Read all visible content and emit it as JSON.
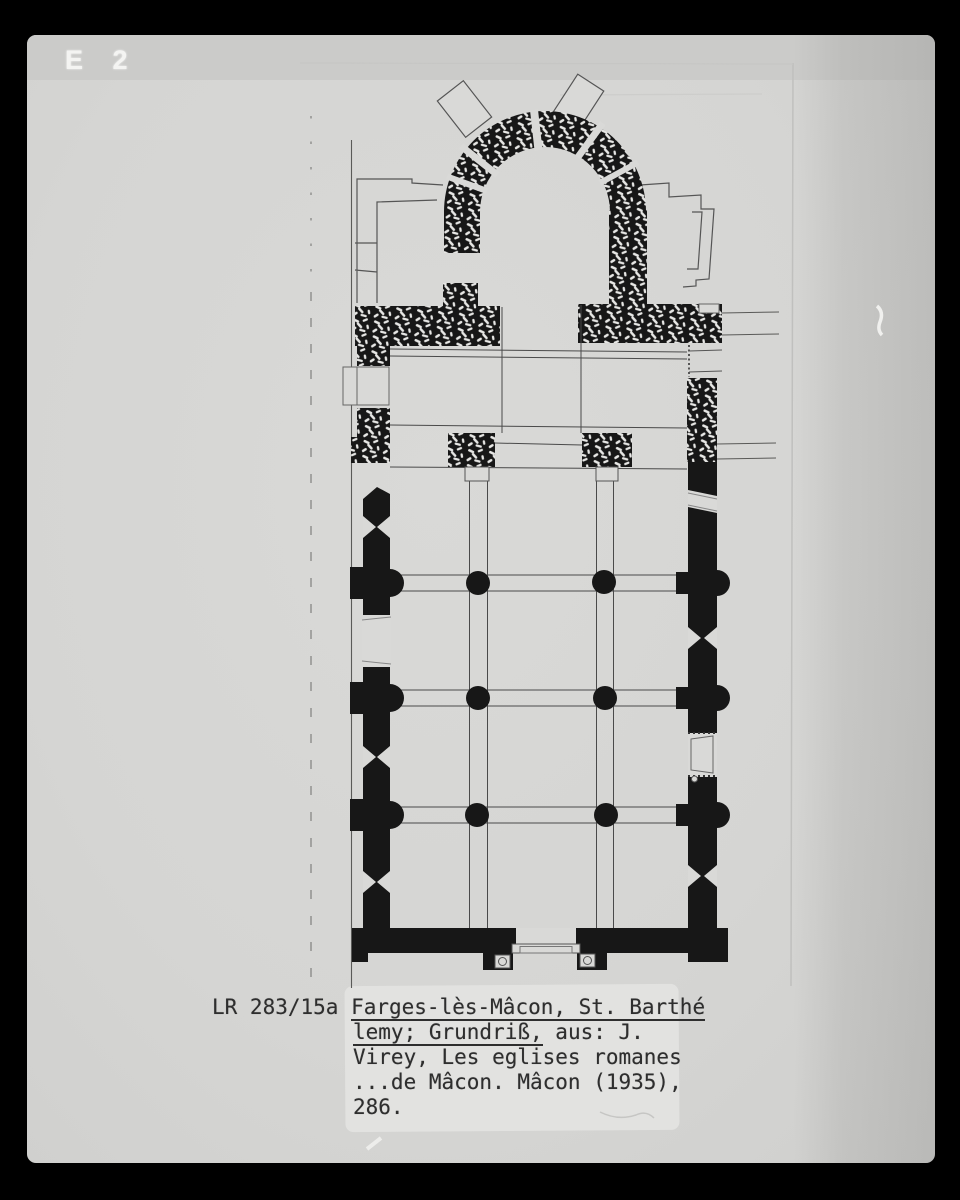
{
  "photo_label": {
    "text": "E 2"
  },
  "caption": {
    "line1_plain": "LR 283/15a ",
    "line1_underlined": "Farges-lès-Mâcon, St. Barthé",
    "line2_underlined": "lemy; Grundriß,",
    "line2_plain": " aus: J.",
    "line3": "Virey, Les eglises romanes",
    "line4": "...de Mâcon. Mâcon (1935),",
    "line5": "286."
  },
  "plan": {
    "type": "church-ground-plan",
    "nave_columns": [
      [
        478,
        583
      ],
      [
        604,
        582
      ],
      [
        478,
        698
      ],
      [
        605,
        698
      ],
      [
        477,
        815
      ],
      [
        606,
        815
      ]
    ],
    "column_radius": 12
  },
  "colors": {
    "border_black": "#000000",
    "photo_gray": "#d6d6d4",
    "top_strip_gray": "#cbcbc9",
    "caption_label": "#e2e2e0",
    "drawing_ink": "#171717",
    "thin_line": "#4a4a4a",
    "caption_ink": "#2e2e2e",
    "photo_label_white": "#f4f4f2"
  }
}
